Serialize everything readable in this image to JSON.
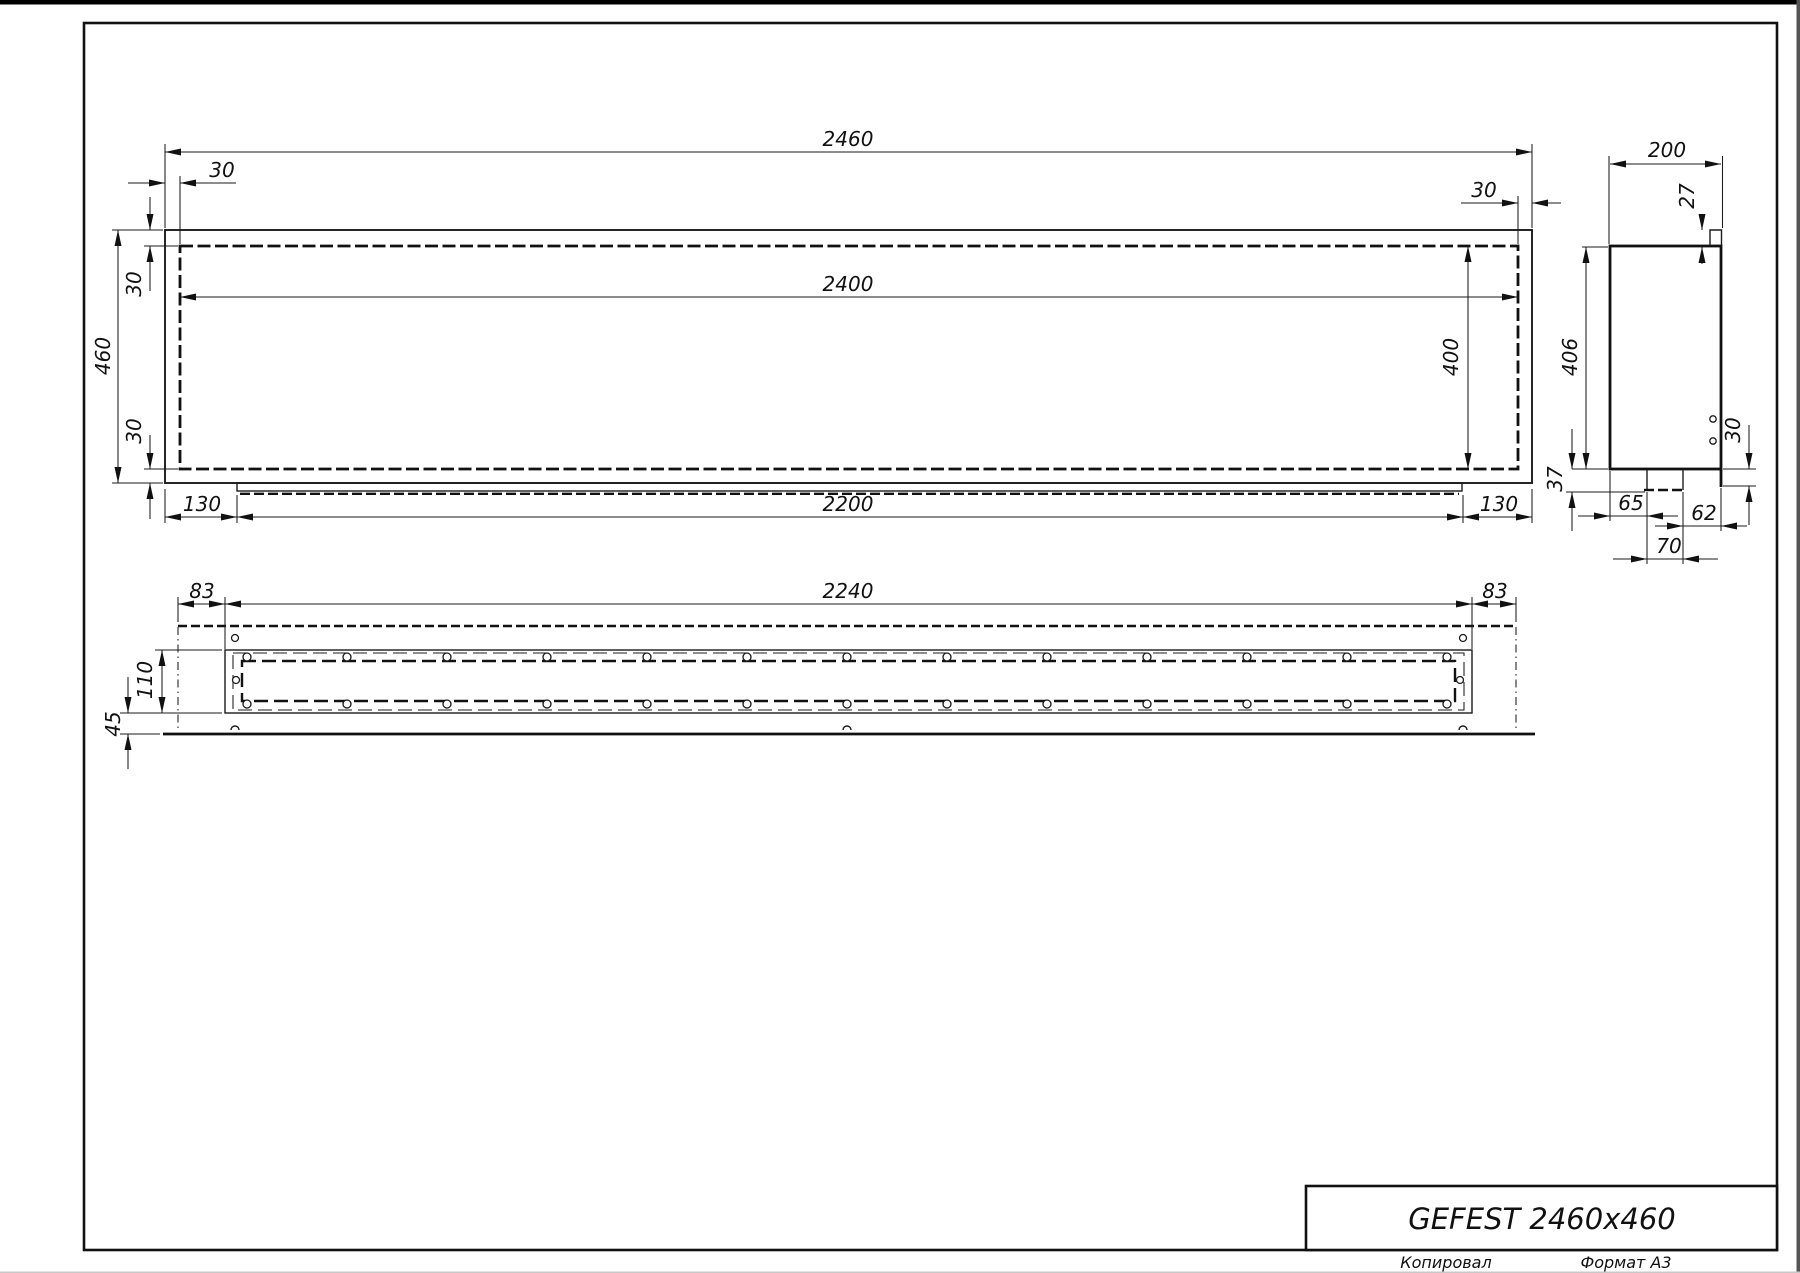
{
  "title_block": {
    "product_name": "GEFEST 2460x460"
  },
  "footer": {
    "copied_by_label": "Копировал",
    "format_label": "Формат А3"
  },
  "front_view": {
    "overall_width": "2460",
    "left_wall": "30",
    "right_wall": "30",
    "opening_width": "2400",
    "overall_height": "460",
    "top_wall": "30",
    "bottom_wall": "30",
    "opening_height": "400",
    "tray_left_offset": "130",
    "tray_length": "2200",
    "tray_right_offset": "130"
  },
  "side_view": {
    "overall_depth": "200",
    "top_lip": "27",
    "overall_height": "406",
    "rear_flange": "30",
    "bracket_drop": "37",
    "bracket_offset": "65",
    "bracket_to_rear": "62",
    "bracket_width": "70"
  },
  "bottom_view": {
    "left_margin": "83",
    "burner_length": "2240",
    "right_margin": "83",
    "burner_depth": "110",
    "rear_flange": "45"
  }
}
